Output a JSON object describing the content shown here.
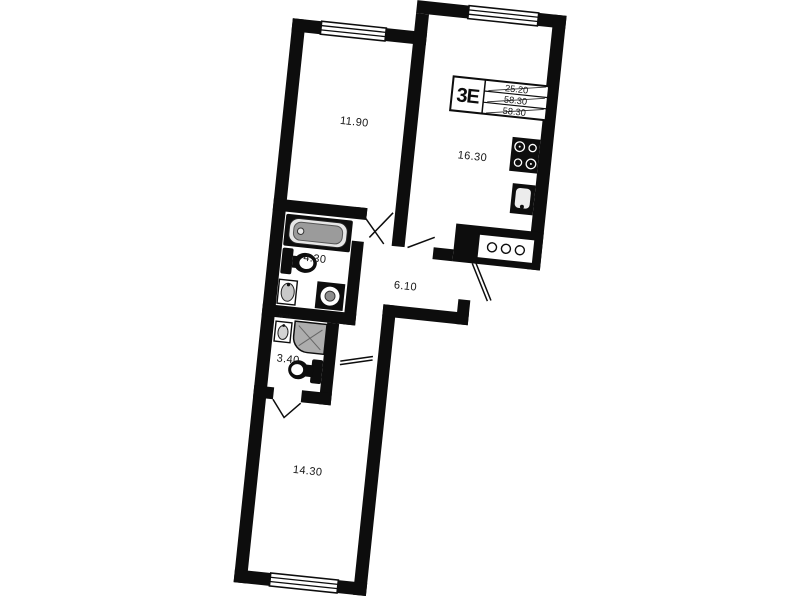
{
  "unit": {
    "type_label": "3Е",
    "area_rows": [
      "25.20",
      "58.30",
      "58.30"
    ]
  },
  "rooms": [
    {
      "key": "living-room",
      "area": "11.90"
    },
    {
      "key": "kitchen-living",
      "area": "16.30"
    },
    {
      "key": "bathroom",
      "area": "4.30"
    },
    {
      "key": "hallway",
      "area": "6.10"
    },
    {
      "key": "wc",
      "area": "3.40"
    },
    {
      "key": "bedroom",
      "area": "14.30"
    }
  ],
  "marks": {
    "washer_spot": "ВСМ"
  },
  "colors": {
    "wall": "#0d0d0d",
    "paper": "#ffffff",
    "fixture_gray": "#9b9b9b",
    "shower_gray": "#adadad"
  }
}
